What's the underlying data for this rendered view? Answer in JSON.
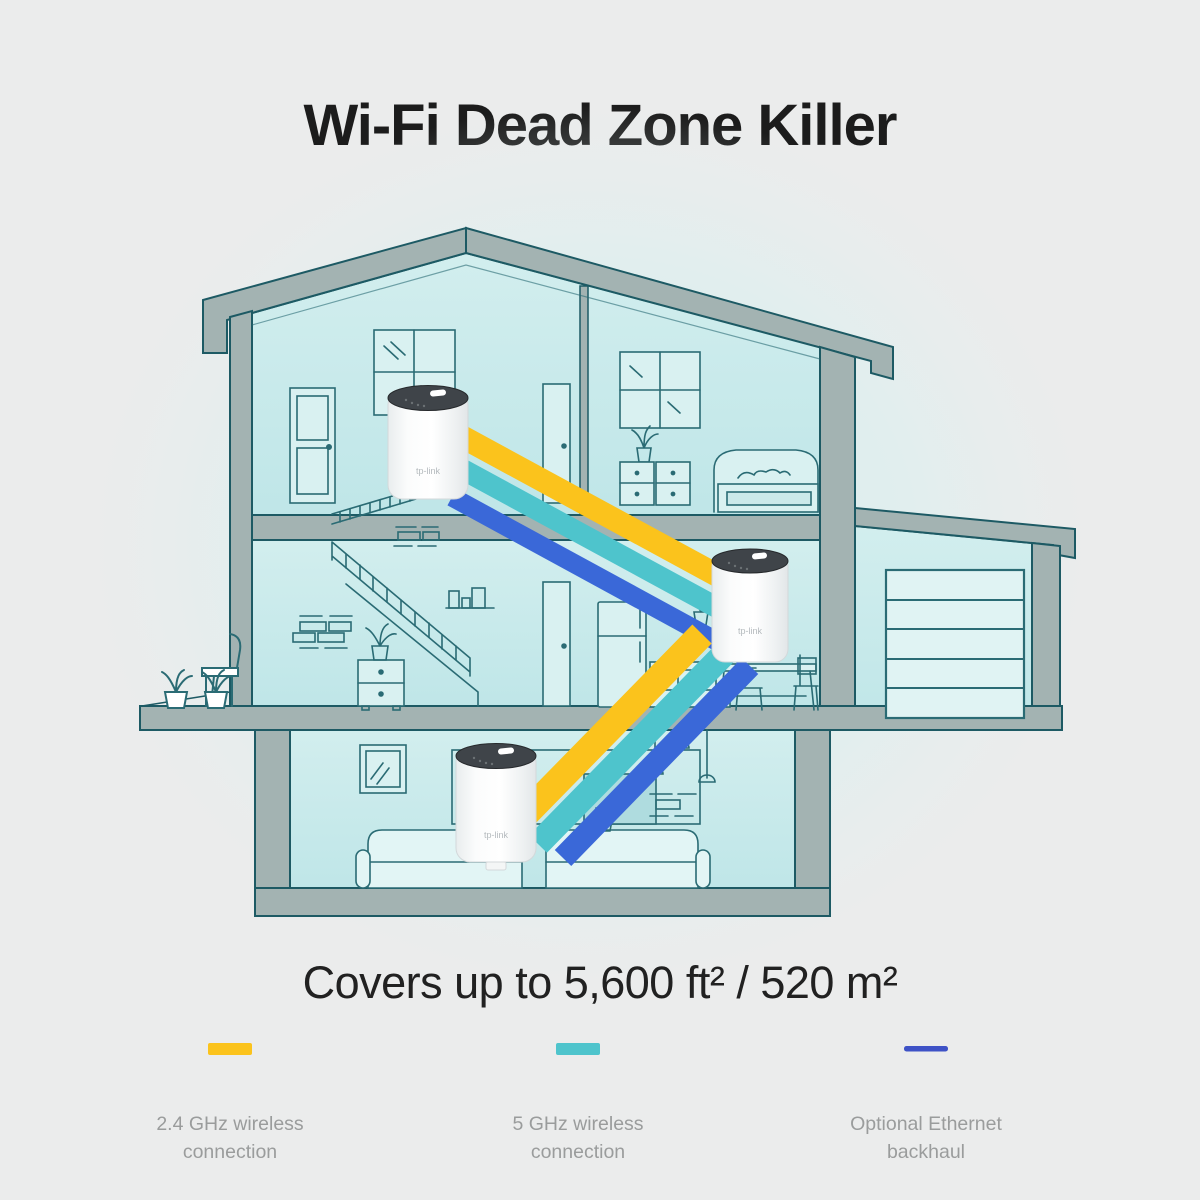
{
  "title": "Wi-Fi Dead Zone Killer",
  "coverage": "Covers up to 5,600 ft² / 520 m²",
  "legend": [
    {
      "line1": "2.4 GHz wireless",
      "line2": "connection",
      "color": "#FBC31C",
      "swatch": "bar"
    },
    {
      "line1": "5 GHz wireless",
      "line2": "connection",
      "color": "#4EC4CC",
      "swatch": "bar"
    },
    {
      "line1": "Optional Ethernet",
      "line2": "backhaul",
      "color": "#3E52C6",
      "swatch": "line"
    }
  ],
  "bands": {
    "wireless_24": "#FBC31C",
    "wireless_5": "#4EC4CC",
    "ethernet": "#3A68D8"
  },
  "devices": [
    {
      "id": "attic-unit",
      "logo": "tp-link"
    },
    {
      "id": "kitchen-unit",
      "logo": "tp-link"
    },
    {
      "id": "living-room-unit",
      "logo": "tp-link"
    }
  ]
}
